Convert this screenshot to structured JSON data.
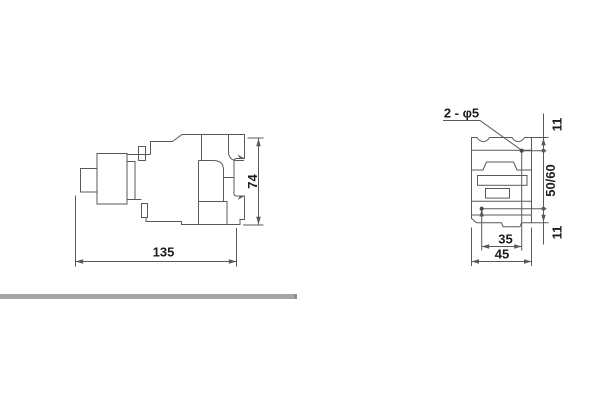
{
  "drawing": {
    "type": "technical-dimension-drawing",
    "side_view": {
      "width_label": "135",
      "height_label": "74"
    },
    "front_view": {
      "holes_label": "2 - φ5",
      "top_offset_label": "11",
      "vertical_pitch_label": "50/60",
      "bottom_offset_label": "11",
      "horizontal_pitch_label": "35",
      "width_label": "45"
    },
    "colors": {
      "line": "#59595b",
      "text": "#1c1c1e",
      "divider_bar": "#a6a6a8"
    }
  }
}
